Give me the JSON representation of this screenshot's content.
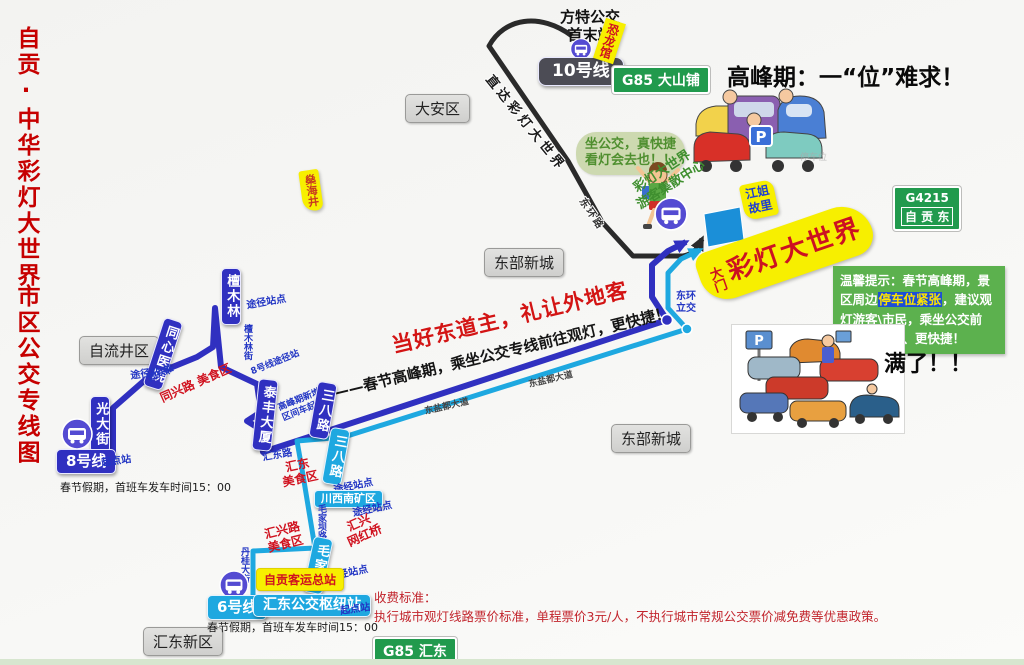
{
  "colors": {
    "route_line8": "#3030c0",
    "route_line6": "#1ea8e0",
    "route_line10": "#2a2a2a",
    "sign_green": "#219a4d",
    "tip_green": "#5cb14e",
    "highlight_yellow": "#f7ef00",
    "accent_red": "#cc1122"
  },
  "title": {
    "part1": "自贡·中华彩灯大世界",
    "part2": "市区公交专线图"
  },
  "p_sign": "P",
  "top": {
    "fangte_line1": "方特公交",
    "fangte_line2": "首末站",
    "line10_badge": "10号线",
    "dinosaur_hall": "恐龙馆",
    "sign_dashanpu": "G85 大山铺",
    "direct_text": "直达彩灯大世界",
    "donghuan_road": "东环路",
    "shenhai_well": "燊海井",
    "peak_headline": "高峰期：一“位”难求！",
    "bubble_line1": "坐公交，真快捷",
    "bubble_line2": "看灯会去也！！",
    "parking_watermark": "停车位"
  },
  "regions": {
    "daan": "大安区",
    "dongbu_1": "东部新城",
    "dongbu_2": "东部新城",
    "ziliujing": "自流井区",
    "huidong": "汇东新区"
  },
  "center": {
    "slogan_red": "当好东道主，礼让外地客",
    "slogan_black": "——春节高峰期，乘坐公交专线前往观灯，更快捷！",
    "road_label_1": "东盐都大道",
    "road_label_2": "东盐都大道",
    "interchange_line1": "东环",
    "interchange_line2": "立交"
  },
  "destination": {
    "visitor_center_line1": "彩灯大世界",
    "visitor_center_line2": "游客集散中心",
    "jiangjie_line1": "江姐",
    "jiangjie_line2": "故里",
    "gate": "大门",
    "name": "彩灯大世界",
    "g4215_code": "G4215",
    "g4215_name": "自 贡 东"
  },
  "tip_box": {
    "prefix": "温馨提示：春节高峰期，景区周边",
    "highlight": "停车位紧张",
    "suffix": "，建议观灯游客\\市民，乘坐公交前往，更方便、更快捷！"
  },
  "full_label": "满了！！",
  "line8": {
    "badge": "8号线",
    "start_label": "起点站",
    "schedule": "春节假期，首班车发车时间15：00",
    "st_tanmulin": "檀木林",
    "tanmulin_note": "途径站点",
    "tanmulin_street": "檀木林街",
    "st_tongxin": "同心医院",
    "tongxin_note": "途径站点",
    "tongxing_road": "同兴路",
    "tongxing_food": "同兴路  美食区",
    "st_guangda": "光大街",
    "st_taifeng": "泰丰大厦",
    "taifeng_note": "8号线途径站",
    "taifeng_extra_line1": "高峰期新增，",
    "taifeng_extra_line2": "区间车起点站",
    "st_sanba": "三八路",
    "huidong_road": "汇东路",
    "huidong_food_line1": "汇东",
    "huidong_food_line2": "美食区"
  },
  "line6": {
    "badge": "6号线",
    "hub": "汇东公交枢纽站",
    "start_label": "起点站",
    "schedule": "春节假期，首班车发车时间15：00",
    "st_sanba": "三八路",
    "sanba_note": "途经站点",
    "st_chuanxinan": "川西南矿区",
    "chuanxinan_note": "途经站点",
    "maojiaba_street": "毛家坝路",
    "huixing_bridge_line1": "汇兴",
    "huixing_bridge_line2": "网红桥",
    "huixing_food_line1": "汇兴路",
    "huixing_food_line2": "美食区",
    "st_maojiaba": "毛家坝",
    "maojiaba_note": "途经站点",
    "dangui_street": "丹桂大街",
    "st_keyun": "自贡客运总站"
  },
  "fare": {
    "line1": "收费标准：",
    "line2": "执行城市观灯线路票价标准，单程票价3元/人，不执行城市常规公交票价减免费等优惠政策。"
  },
  "sign_huidong": "G85 汇东"
}
